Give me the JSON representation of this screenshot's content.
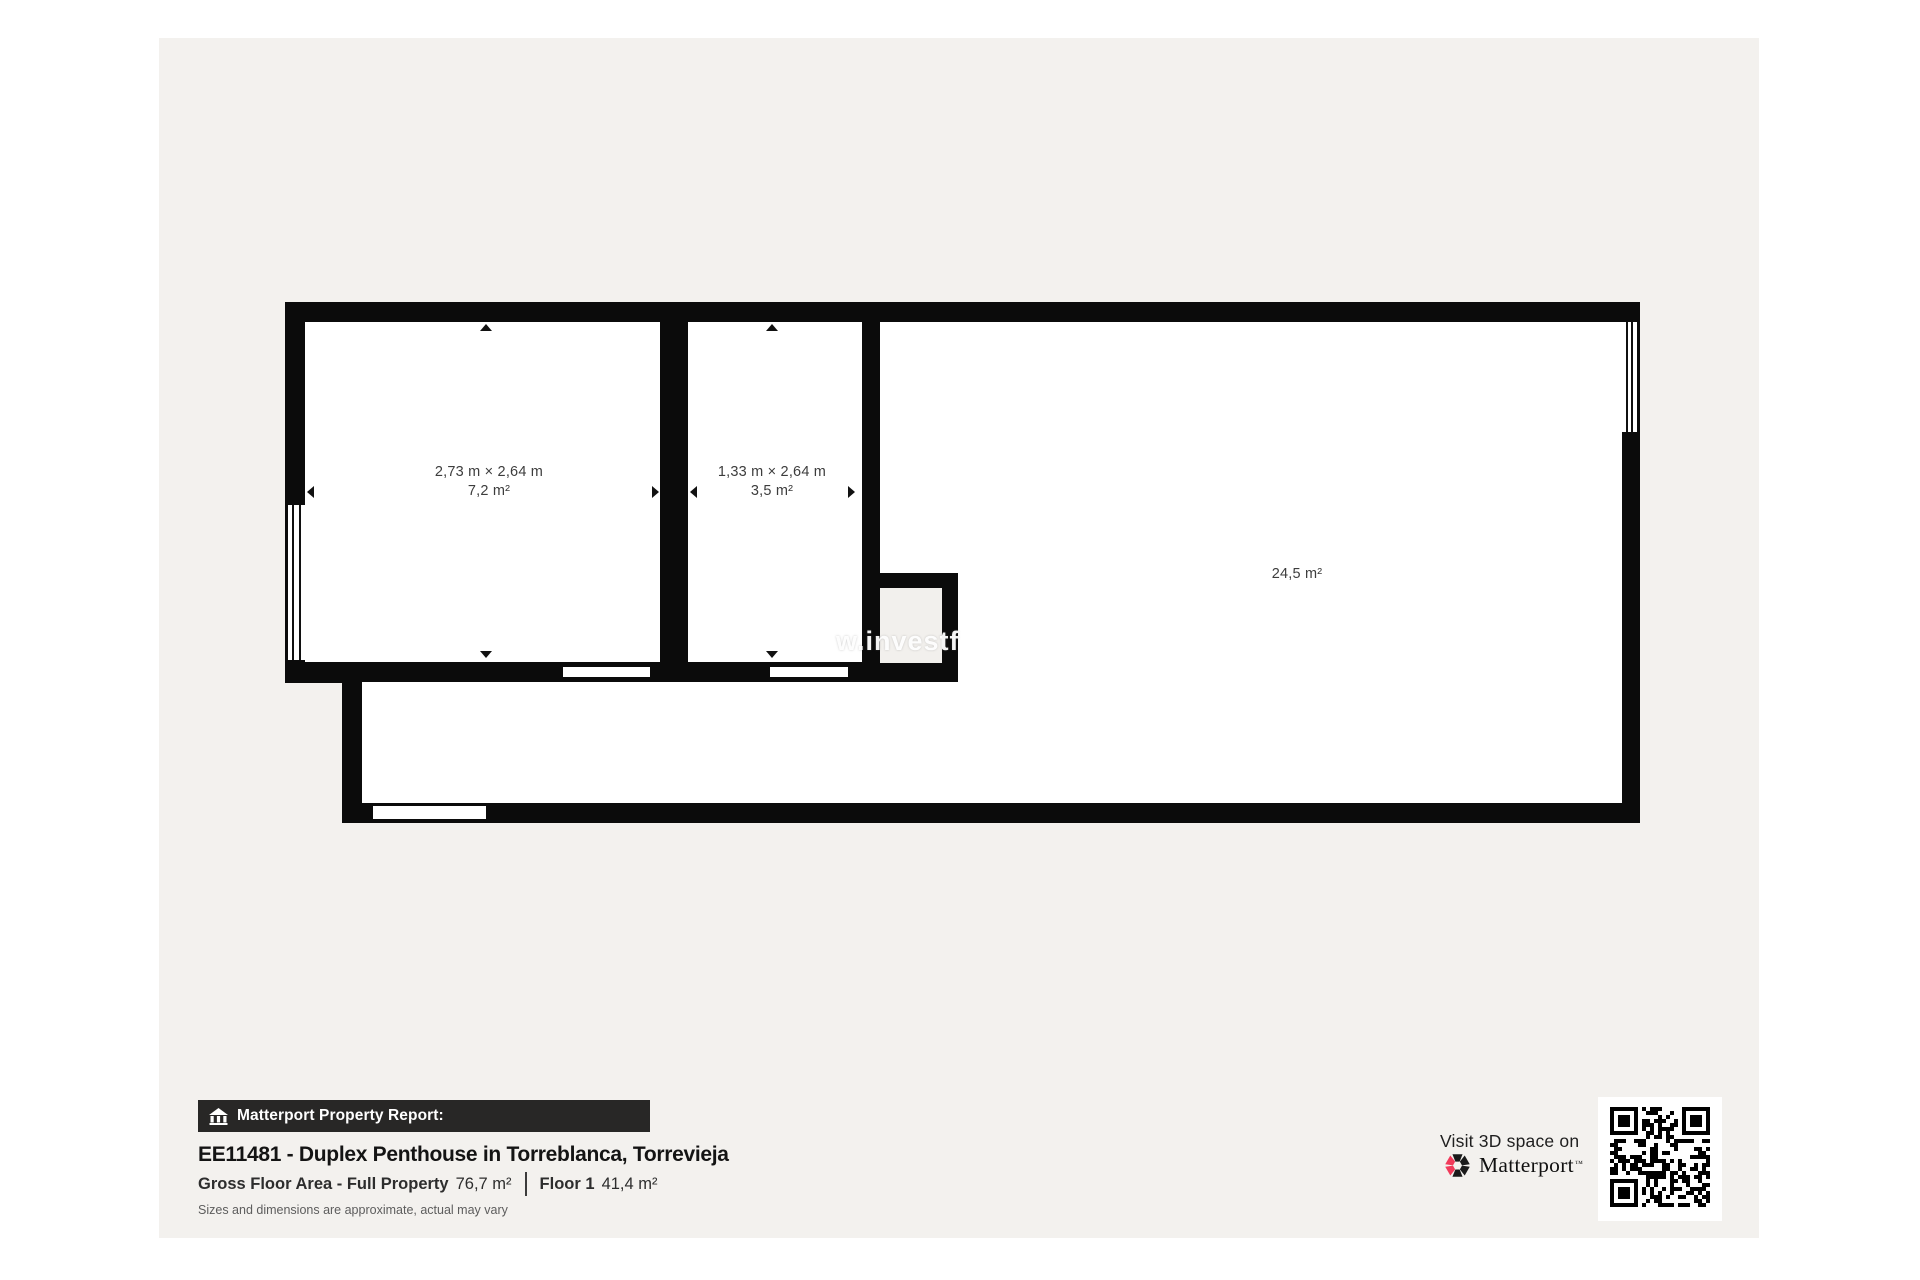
{
  "report": {
    "header_label": "Matterport Property Report:",
    "title": "EE11481 - Duplex Penthouse in Torreblanca, Torrevieja",
    "gross_floor_label": "Gross Floor Area - Full Property",
    "gross_floor_value": "76,7 m²",
    "floor_label": "Floor 1",
    "floor_value": "41,4 m²",
    "disclaimer": "Sizes and dimensions are approximate, actual may vary"
  },
  "floorplan": {
    "rooms": [
      {
        "dimensions": "2,73 m × 2,64 m",
        "area": "7,2 m²"
      },
      {
        "dimensions": "1,33 m × 2,64 m",
        "area": "3,5 m²"
      },
      {
        "area": "24,5 m²"
      }
    ],
    "watermark": "w.investf"
  },
  "promo": {
    "visit_label": "Visit 3D space on",
    "brand": "Matterport",
    "trademark": "™"
  },
  "colors": {
    "page_bg": "#f3f1ee",
    "wall": "#0b0b0b",
    "accent_red": "#f13a5a",
    "header_bar_bg": "#282726"
  }
}
